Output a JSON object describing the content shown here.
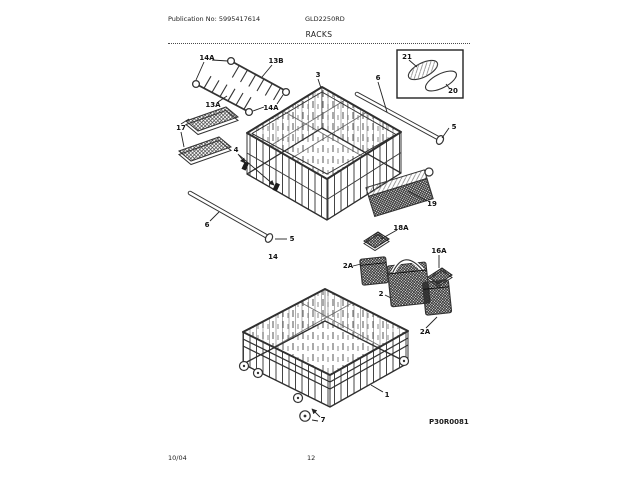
{
  "header": {
    "publication_no": "Publication No: 5995417614",
    "model": "GLD2250RD",
    "section_title": "RACKS"
  },
  "footer": {
    "revision_date": "10/04",
    "page_number": "12"
  },
  "diagram": {
    "figure_id": "P30R0081",
    "callouts": [
      {
        "label": "14A"
      },
      {
        "label": "13B"
      },
      {
        "label": "13A"
      },
      {
        "label": "14A"
      },
      {
        "label": "17"
      },
      {
        "label": "3"
      },
      {
        "label": "6"
      },
      {
        "label": "21"
      },
      {
        "label": "20"
      },
      {
        "label": "5"
      },
      {
        "label": "4"
      },
      {
        "label": "19"
      },
      {
        "label": "18A"
      },
      {
        "label": "16A"
      },
      {
        "label": "2A"
      },
      {
        "label": "2"
      },
      {
        "label": "2A"
      },
      {
        "label": "6"
      },
      {
        "label": "5"
      },
      {
        "label": "14"
      },
      {
        "label": "1"
      },
      {
        "label": "7"
      }
    ]
  }
}
